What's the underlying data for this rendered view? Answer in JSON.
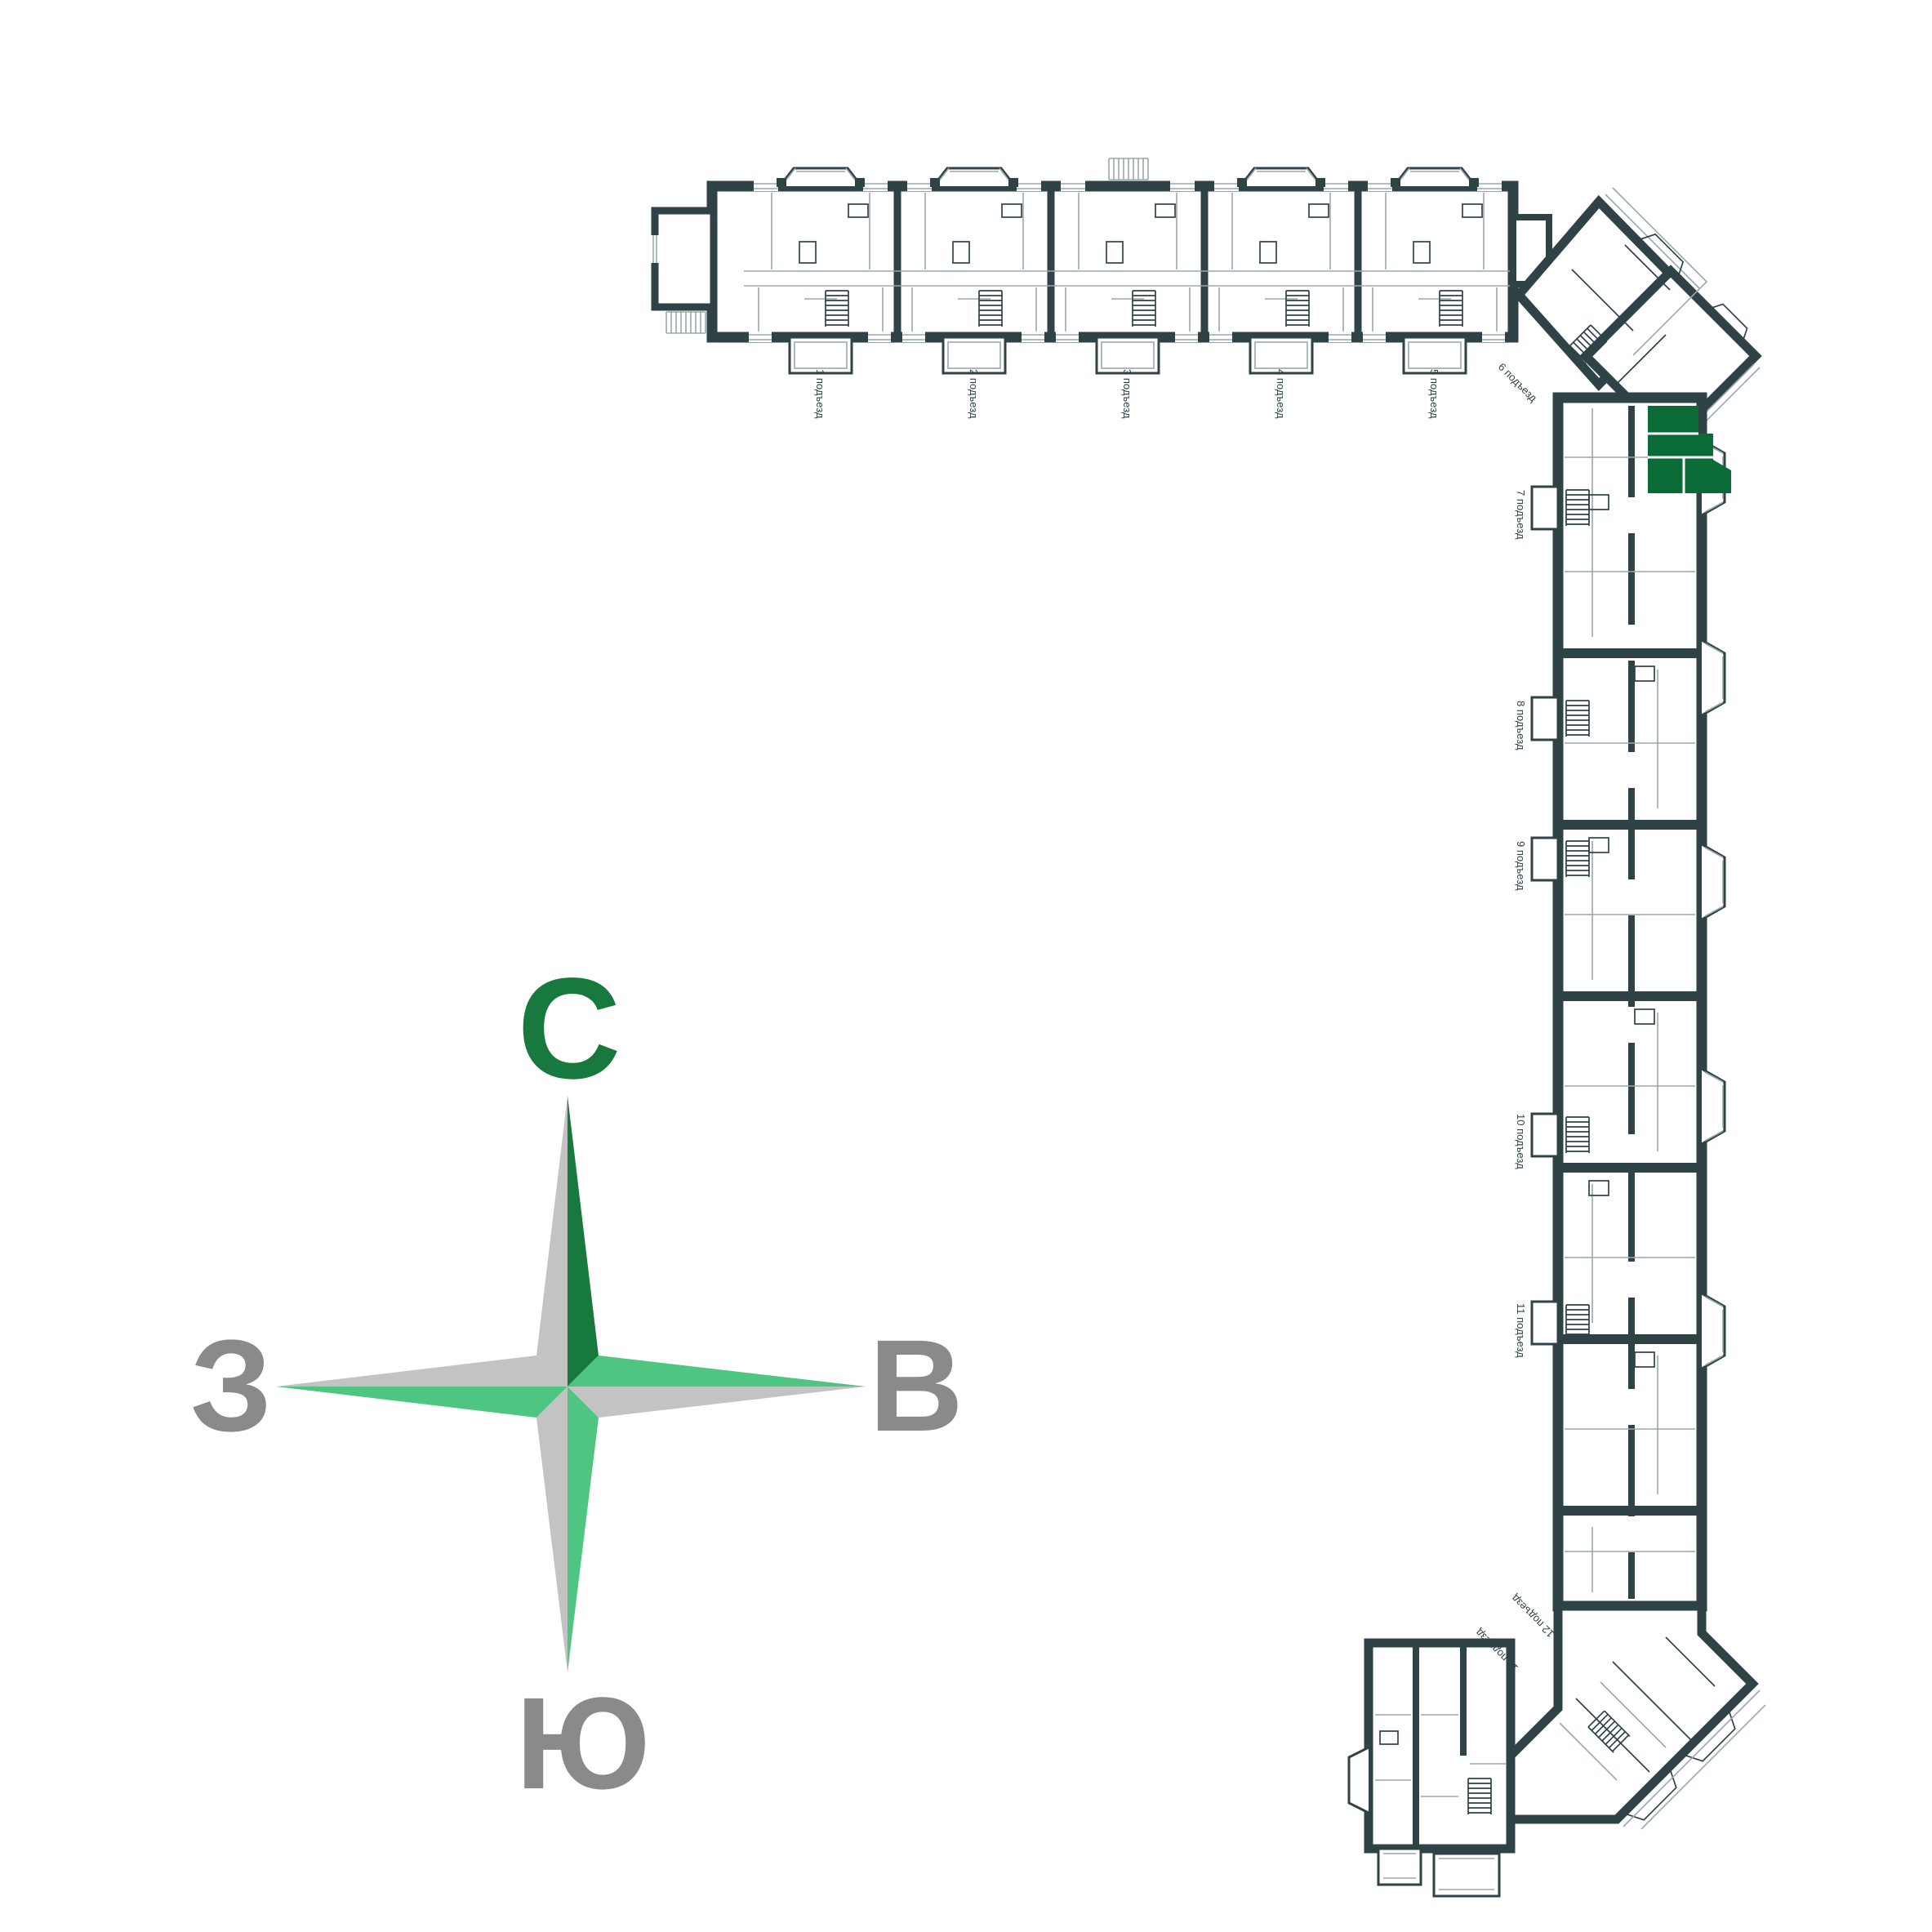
{
  "plan": {
    "wall_color": "#2F4347",
    "detail_color": "#9AA8AC",
    "background": "#FFFFFF",
    "entrances": [
      {
        "label": "1 подъезд"
      },
      {
        "label": "2 подъезд"
      },
      {
        "label": "3 подъезд"
      },
      {
        "label": "4 подъезд"
      },
      {
        "label": "5 подъезд"
      },
      {
        "label": "6 подъезд"
      },
      {
        "label": "7 подъезд"
      },
      {
        "label": "8 подъезд"
      },
      {
        "label": "9 подъезд"
      },
      {
        "label": "10 подъезд"
      },
      {
        "label": "11 подъезд"
      },
      {
        "label": "12 подъезд"
      },
      {
        "label": "13 подъезд"
      }
    ],
    "highlight": {
      "color": "#0A6B36",
      "entrance_label": "7 подъезд"
    }
  },
  "compass": {
    "north": "С",
    "east": "В",
    "south": "Ю",
    "west": "З",
    "colors": {
      "north_arm": "#17793D",
      "accent_arm": "#4EC581",
      "gray_arm": "#C3C3C3",
      "north_label": "#17793D",
      "label_gray": "#8A8A8A"
    }
  }
}
